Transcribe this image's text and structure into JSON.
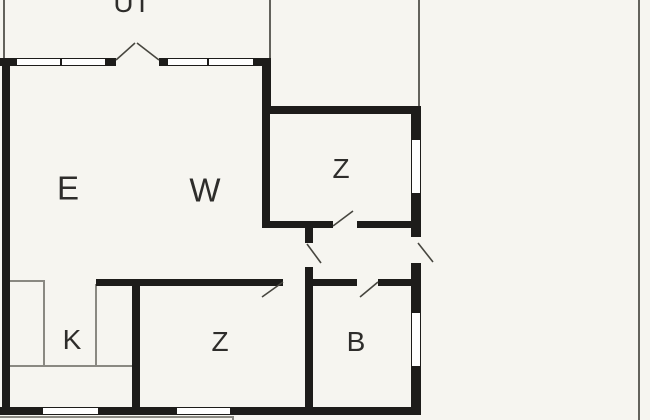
{
  "plan": {
    "type": "floor-plan",
    "rooms": [
      {
        "id": "ut",
        "label": "UT"
      },
      {
        "id": "e",
        "label": "E"
      },
      {
        "id": "w",
        "label": "W"
      },
      {
        "id": "z-upper",
        "label": "Z"
      },
      {
        "id": "k",
        "label": "K"
      },
      {
        "id": "z-lower",
        "label": "Z"
      },
      {
        "id": "b",
        "label": "B"
      }
    ],
    "colors": {
      "background": "#f6f5f0",
      "wall": "#1d1c1a",
      "thin_line": "#63625c",
      "swing_line": "#47463f",
      "window_fill": "#ffffff",
      "label_text": "#2e2d2b"
    }
  }
}
